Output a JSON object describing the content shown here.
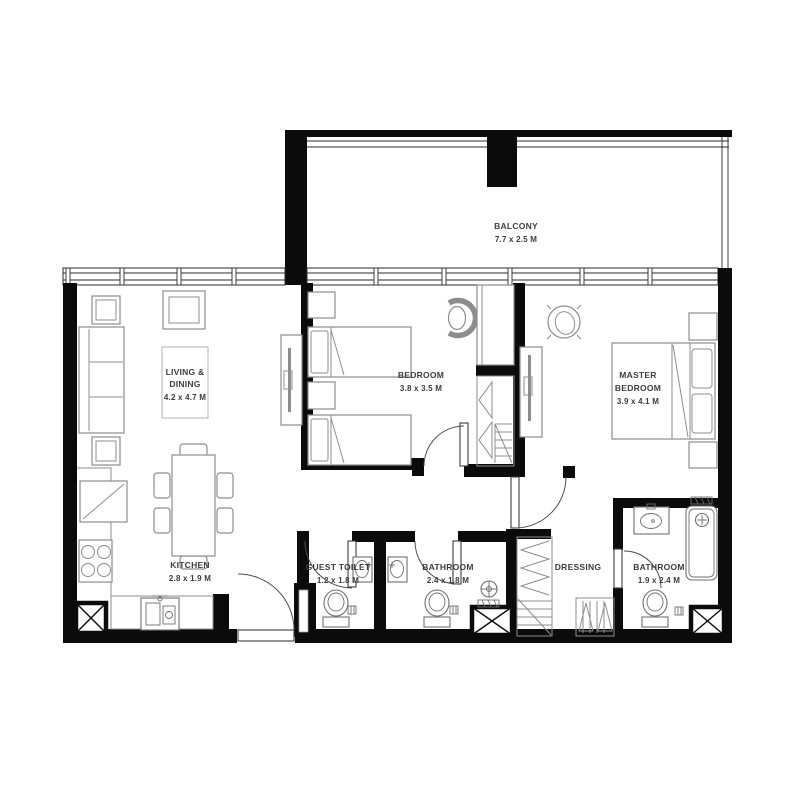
{
  "canvas": {
    "width": 800,
    "height": 800,
    "background": "#ffffff"
  },
  "colors": {
    "wall": "#0b0b0b",
    "furniture_stroke": "#8d8d8d",
    "fixture_stroke": "#6f6f6f",
    "door_arc": "#4f4f4f",
    "label_text": "#3c3c3c",
    "background": "#ffffff"
  },
  "rooms": {
    "balcony": {
      "name": "BALCONY",
      "dims": "7.7 x 2.5 M"
    },
    "living_dining": {
      "name_line1": "LIVING &",
      "name_line2": "DINING",
      "dims": "4.2 x 4.7 M"
    },
    "kitchen": {
      "name": "KITCHEN",
      "dims": "2.8 x 1.9 M"
    },
    "bedroom": {
      "name": "BEDROOM",
      "dims": "3.8 x 3.5 M"
    },
    "master_bedroom": {
      "name_line1": "MASTER",
      "name_line2": "BEDROOM",
      "dims": "3.9 x 4.1 M"
    },
    "guest_toilet": {
      "name": "GUEST TOILET",
      "dims": "1.2 x 1.8 M"
    },
    "bathroom": {
      "name": "BATHROOM",
      "dims": "2.4 x 1.8 M"
    },
    "dressing": {
      "name": "DRESSING"
    },
    "master_bathroom": {
      "name": "BATHROOM",
      "dims": "1.9 x 2.4 M"
    }
  }
}
